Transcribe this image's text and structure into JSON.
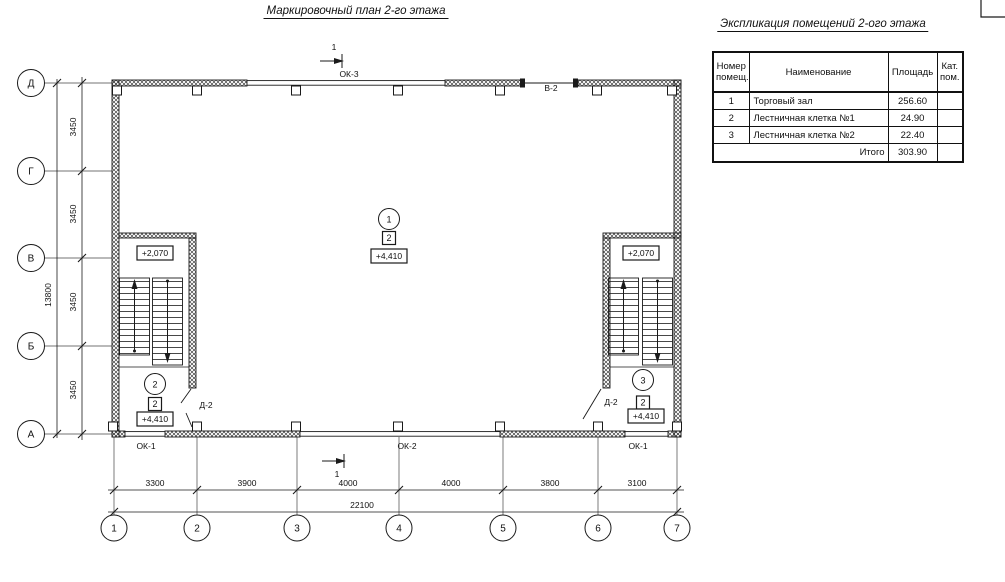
{
  "titles": {
    "plan": "Маркировочный план 2-го этажа",
    "schedule": "Экспликация помещений 2-ого этажа"
  },
  "schedule_table": {
    "headers": {
      "num_l1": "Номер",
      "num_l2": "помещ.",
      "name": "Наименование",
      "area": "Площадь",
      "cat_l1": "Кат.",
      "cat_l2": "пом."
    },
    "rows": [
      {
        "num": "1",
        "name": "Торговый зал",
        "area": "256.60",
        "cat": ""
      },
      {
        "num": "2",
        "name": "Лестничная клетка №1",
        "area": "24.90",
        "cat": ""
      },
      {
        "num": "3",
        "name": "Лестничная клетка №2",
        "area": "22.40",
        "cat": ""
      }
    ],
    "total": {
      "label": "Итого",
      "area": "303.90"
    }
  },
  "plan": {
    "row_axes": [
      "Д",
      "Г",
      "В",
      "Б",
      "А"
    ],
    "col_axes": [
      "1",
      "2",
      "3",
      "4",
      "5",
      "6",
      "7"
    ],
    "dims": {
      "left_segments": [
        "3450",
        "3450",
        "3450",
        "3450"
      ],
      "left_total": "13800",
      "bottom_segments": [
        "3300",
        "3900",
        "4000",
        "4000",
        "3800",
        "3100"
      ],
      "bottom_total": "22100"
    },
    "labels": {
      "window_ok1": "ОК-1",
      "window_ok2": "ОК-2",
      "window_ok3": "ОК-3",
      "vent_v2": "В-2",
      "door_d2": "Д-2",
      "level_stair": "+2,070",
      "level_floor": "+4,410"
    },
    "rooms": {
      "hall": "1",
      "stair1": "2",
      "stair2": "3",
      "storey_badge": "2"
    },
    "section_marker": "1",
    "colors": {
      "line": "#1a1a1a",
      "background": "#ffffff"
    }
  }
}
